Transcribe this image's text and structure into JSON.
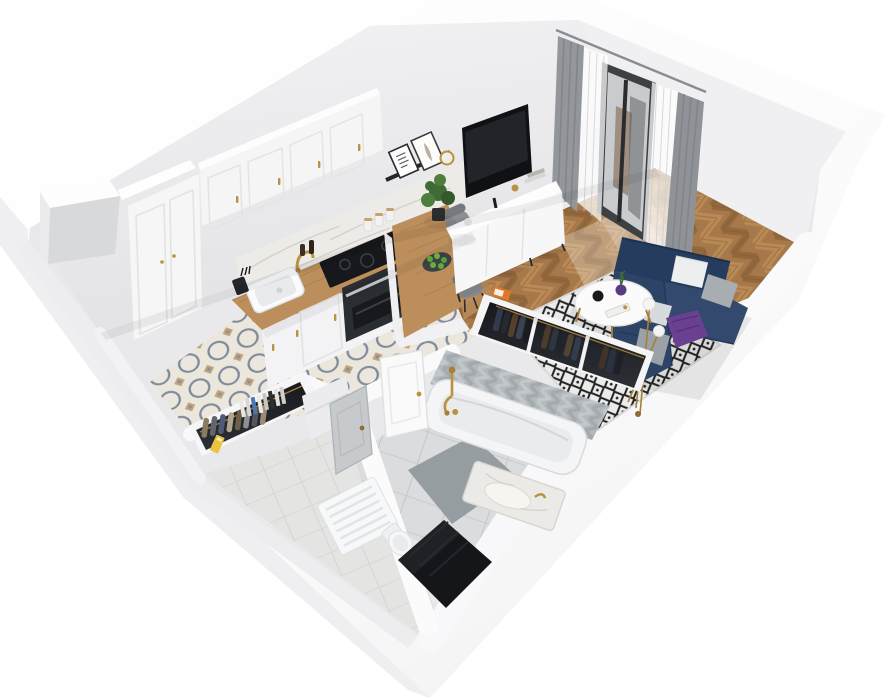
{
  "meta": {
    "title": "3D apartment floor plan — isometric cutaway render",
    "style": "dollhouse bird's-eye view, white cut walls, transparent background",
    "visible_text": "none"
  },
  "palette": {
    "background": "#ffffff",
    "wall_white": "#fbfbfc",
    "wall_face_grey": "#e9e9eb",
    "kitchen_wood": "#bb8e5c",
    "living_wood": "#a7794a",
    "tile_cream": "#ece7dd",
    "tile_blue_grey": "#7f8a9c",
    "tile_tan": "#c2a478",
    "sofa_navy": "#2e4466",
    "pillow_grey": "#a8adb2",
    "throw_purple": "#6a4190",
    "rug_ground": "#ebebe8",
    "rug_diamond": "#212327",
    "brass": "#a5803c",
    "curtain_grey": "#93979b",
    "bath_tile_grey": "#b3b8bc",
    "bath_floor_grey": "#dadcdd",
    "appliance_black": "#17181b",
    "entrance_mat_black": "#141619",
    "apple_green": "#5fae3a"
  },
  "rooms": {
    "kitchen": {
      "label": "Kitchen",
      "floor": "ornamental cream tiles with blue-grey medallions and tan accents",
      "items": [
        "ventilation shaft column",
        "tall white cabinet column",
        "white shaker upper cabinets with brass pulls",
        "marble backsplash",
        "wooden L-countertop",
        "white sink with brass faucet",
        "black induction cooktop",
        "built-in black oven",
        "knife block",
        "pepper mills",
        "storage canisters",
        "peninsula bar with plate of green apples",
        "two grey dining chairs"
      ]
    },
    "living": {
      "label": "Living room",
      "floor": "oak herringbone parquet",
      "items": [
        "black picture-ledge shelf with two framed prints and round brass mirror",
        "flat-screen TV",
        "white media console with books and brass cup",
        "potted green plant",
        "black-framed balcony door",
        "white sheer curtains",
        "grey drapes",
        "navy corner sofa",
        "white and grey cushions",
        "purple throw",
        "black-and-white diamond rug",
        "round white coffee table with black vase, purple vase and book",
        "brass floor lamp with three glass globes"
      ]
    },
    "wardrobes": {
      "label": "Wardrobe niches",
      "items": [
        "recessed closet with dark hanging clothes on brass rail",
        "entry closet with light hanging clothes",
        "row of books on half wall",
        "yellow box",
        "orange magazine"
      ]
    },
    "bathroom": {
      "label": "Bathroom",
      "floor": "large grey tiles with dark grey mat",
      "items": [
        "white bathtub with brass shower mixer",
        "grey herringbone wall tiles",
        "marble vanity with brass tap",
        "white towel radiator",
        "toilet",
        "white bathroom door"
      ]
    },
    "hallway": {
      "label": "Hallway / entry",
      "floor": "light grey tiles",
      "items": [
        "black entrance mat",
        "grey interior door"
      ]
    }
  }
}
